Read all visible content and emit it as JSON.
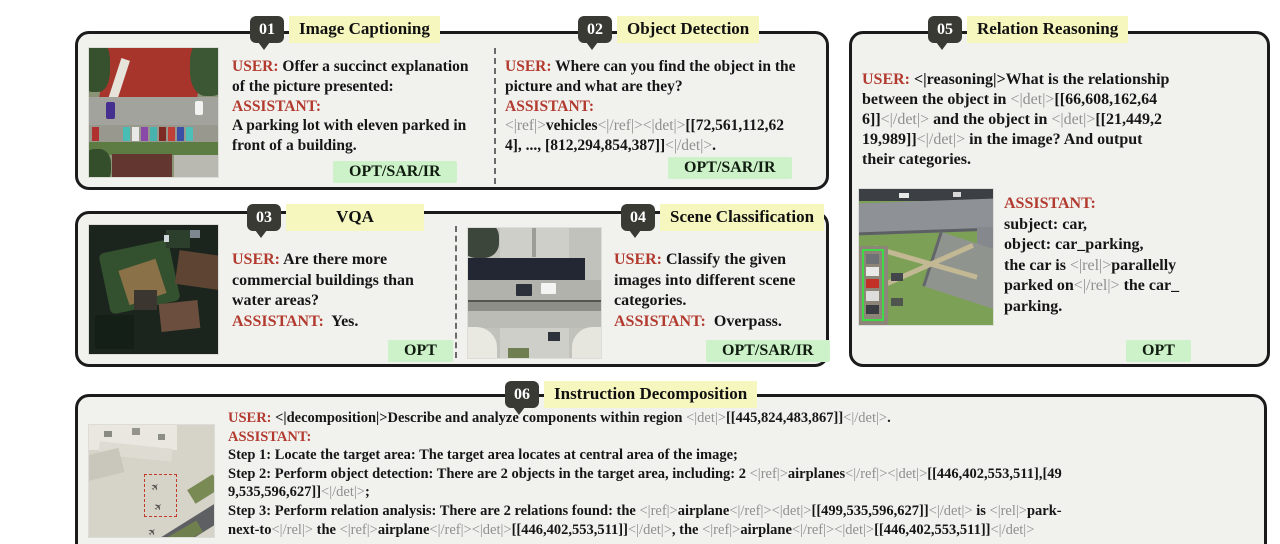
{
  "colors": {
    "panel_bg": "#f1f1ee",
    "panel_border": "#1b1b1b",
    "badge_bg": "#3a3a35",
    "title_highlight": "#f6f6bf",
    "speaker_red": "#b23a2e",
    "token_gray": "#8f8f8f",
    "tag_bg": "#cdf2c9"
  },
  "panels": [
    {
      "num": "01",
      "title": "Image Captioning",
      "tag": "OPT/SAR/IR",
      "lines": [
        [
          {
            "t": "USER: ",
            "c": "r"
          },
          {
            "t": "Offer a succinct explanation",
            "c": "k"
          }
        ],
        [
          {
            "t": "of the picture presented:",
            "c": "k"
          }
        ],
        [
          {
            "t": "ASSISTANT:",
            "c": "r"
          }
        ],
        [
          {
            "t": "A parking lot with eleven parked in",
            "c": "k"
          }
        ],
        [
          {
            "t": "front of a building.",
            "c": "k"
          }
        ]
      ]
    },
    {
      "num": "02",
      "title": "Object Detection",
      "tag": "OPT/SAR/IR",
      "lines": [
        [
          {
            "t": "USER: ",
            "c": "r"
          },
          {
            "t": "Where can you find the object in the",
            "c": "k"
          }
        ],
        [
          {
            "t": "picture and what are they?",
            "c": "k"
          }
        ],
        [
          {
            "t": "ASSISTANT:",
            "c": "r"
          }
        ],
        [
          {
            "t": "<|ref|>",
            "c": "g"
          },
          {
            "t": "vehicles",
            "c": "k"
          },
          {
            "t": "<|/ref|><|det|>",
            "c": "g"
          },
          {
            "t": "[[72,561,112,62",
            "c": "k"
          }
        ],
        [
          {
            "t": "4], ..., [812,294,854,387]]",
            "c": "k"
          },
          {
            "t": "<|/det|>",
            "c": "g"
          },
          {
            "t": ".",
            "c": "k"
          }
        ]
      ]
    },
    {
      "num": "03",
      "title": "VQA",
      "tag": "OPT",
      "lines": [
        [
          {
            "t": "USER: ",
            "c": "r"
          },
          {
            "t": "Are there more",
            "c": "k"
          }
        ],
        [
          {
            "t": "commercial buildings than",
            "c": "k"
          }
        ],
        [
          {
            "t": "water areas?",
            "c": "k"
          }
        ],
        [
          {
            "t": "ASSISTANT:",
            "c": "r"
          },
          {
            "t": "  Yes.",
            "c": "k"
          }
        ]
      ]
    },
    {
      "num": "04",
      "title": "Scene Classification",
      "tag": "OPT/SAR/IR",
      "lines": [
        [
          {
            "t": "USER: ",
            "c": "r"
          },
          {
            "t": "Classify the given",
            "c": "k"
          }
        ],
        [
          {
            "t": "images into different scene",
            "c": "k"
          }
        ],
        [
          {
            "t": "categories.",
            "c": "k"
          }
        ],
        [
          {
            "t": "ASSISTANT:",
            "c": "r"
          },
          {
            "t": "  Overpass.",
            "c": "k"
          }
        ]
      ]
    },
    {
      "num": "05",
      "title": "Relation Reasoning",
      "tag": "OPT",
      "user_lines": [
        [
          {
            "t": "USER: ",
            "c": "r"
          },
          {
            "t": "<|reasoning|>What is the relationship",
            "c": "k"
          }
        ],
        [
          {
            "t": "between the object in ",
            "c": "k"
          },
          {
            "t": "<|det|>",
            "c": "g"
          },
          {
            "t": "[[66,608,162,64",
            "c": "k"
          }
        ],
        [
          {
            "t": "6]]",
            "c": "k"
          },
          {
            "t": "<|/det|>",
            "c": "g"
          },
          {
            "t": " and the object in ",
            "c": "k"
          },
          {
            "t": "<|det|>",
            "c": "g"
          },
          {
            "t": "[[21,449,2",
            "c": "k"
          }
        ],
        [
          {
            "t": "19,989]]",
            "c": "k"
          },
          {
            "t": "<|/det|>",
            "c": "g"
          },
          {
            "t": " in the image? And output",
            "c": "k"
          }
        ],
        [
          {
            "t": "their categories.",
            "c": "k"
          }
        ]
      ],
      "assistant_lines": [
        [
          {
            "t": "ASSISTANT:",
            "c": "r"
          }
        ],
        [
          {
            "t": "subject: car,",
            "c": "k"
          }
        ],
        [
          {
            "t": "object: car_parking,",
            "c": "k"
          }
        ],
        [
          {
            "t": "the car is ",
            "c": "k"
          },
          {
            "t": "<|rel|>",
            "c": "g"
          },
          {
            "t": "parallelly",
            "c": "k"
          }
        ],
        [
          {
            "t": "parked on",
            "c": "k"
          },
          {
            "t": "<|/rel|>",
            "c": "g"
          },
          {
            "t": " the car_",
            "c": "k"
          }
        ],
        [
          {
            "t": "parking.",
            "c": "k"
          }
        ]
      ]
    },
    {
      "num": "06",
      "title": "Instruction Decomposition",
      "lines": [
        [
          {
            "t": "USER: ",
            "c": "r"
          },
          {
            "t": "<|decomposition|>Describe and analyze components within region ",
            "c": "k"
          },
          {
            "t": "<|det|>",
            "c": "g"
          },
          {
            "t": "[[445,824,483,867]]",
            "c": "k"
          },
          {
            "t": "<|/det|>",
            "c": "g"
          },
          {
            "t": ".",
            "c": "k"
          }
        ],
        [
          {
            "t": "ASSISTANT:",
            "c": "r"
          }
        ],
        [
          {
            "t": "Step 1: Locate the target area: The target area locates at central area of the image;",
            "c": "k"
          }
        ],
        [
          {
            "t": "Step 2: Perform object detection: There are 2 objects in the target area, including: 2 ",
            "c": "k"
          },
          {
            "t": "<|ref|>",
            "c": "g"
          },
          {
            "t": "airplanes",
            "c": "k"
          },
          {
            "t": "<|/ref|><|det|>",
            "c": "g"
          },
          {
            "t": "[[446,402,553,511],[49",
            "c": "k"
          }
        ],
        [
          {
            "t": "9,535,596,627]]",
            "c": "k"
          },
          {
            "t": "<|/det|>",
            "c": "g"
          },
          {
            "t": ";",
            "c": "k"
          }
        ],
        [
          {
            "t": "Step 3: Perform relation analysis: There are 2 relations found: the ",
            "c": "k"
          },
          {
            "t": "<|ref|>",
            "c": "g"
          },
          {
            "t": "airplane",
            "c": "k"
          },
          {
            "t": "<|/ref|><|det|>",
            "c": "g"
          },
          {
            "t": "[[499,535,596,627]]",
            "c": "k"
          },
          {
            "t": "<|/det|>",
            "c": "g"
          },
          {
            "t": " is ",
            "c": "k"
          },
          {
            "t": "<|rel|>",
            "c": "g"
          },
          {
            "t": "park-",
            "c": "k"
          }
        ],
        [
          {
            "t": "next-to",
            "c": "k"
          },
          {
            "t": "<|/rel|>",
            "c": "g"
          },
          {
            "t": " the ",
            "c": "k"
          },
          {
            "t": "<|ref|>",
            "c": "g"
          },
          {
            "t": "airplane",
            "c": "k"
          },
          {
            "t": "<|/ref|><|det|>",
            "c": "g"
          },
          {
            "t": "[[446,402,553,511]]",
            "c": "k"
          },
          {
            "t": "<|/det|>",
            "c": "g"
          },
          {
            "t": ", the ",
            "c": "k"
          },
          {
            "t": "<|ref|>",
            "c": "g"
          },
          {
            "t": "airplane",
            "c": "k"
          },
          {
            "t": "<|/ref|><|det|>",
            "c": "g"
          },
          {
            "t": "[[446,402,553,511]]",
            "c": "k"
          },
          {
            "t": "<|/det|>",
            "c": "g"
          }
        ]
      ]
    }
  ]
}
